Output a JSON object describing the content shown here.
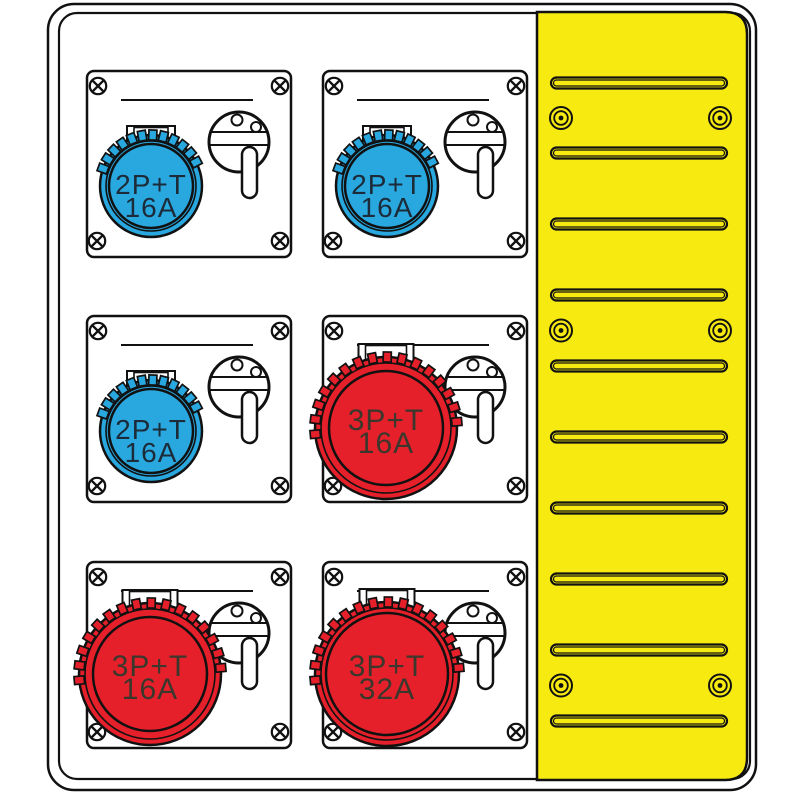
{
  "board": {
    "description": "Industrial power distribution board illustration with six interlocked CEE socket modules and a yellow vented side panel",
    "colors": {
      "line": "#111111",
      "plate": "#ffffff",
      "blue_socket": "#29A8E0",
      "red_socket": "#E6202A",
      "panel_yellow": "#F7EA11",
      "blue_label_text": "#1C2B39",
      "red_label_text": "#3B372D"
    },
    "modules": [
      {
        "position": "top-left",
        "type": "blue",
        "socket_type": "2P+T",
        "rating": "16A",
        "label_line1": "2P+T",
        "label_line2": "16A",
        "color": "#29A8E0",
        "label_color": "#1C2B39"
      },
      {
        "position": "top-right",
        "type": "blue",
        "socket_type": "2P+T",
        "rating": "16A",
        "label_line1": "2P+T",
        "label_line2": "16A",
        "color": "#29A8E0",
        "label_color": "#1C2B39"
      },
      {
        "position": "middle-left",
        "type": "blue",
        "socket_type": "2P+T",
        "rating": "16A",
        "label_line1": "2P+T",
        "label_line2": "16A",
        "color": "#29A8E0",
        "label_color": "#1C2B39"
      },
      {
        "position": "middle-right",
        "type": "red16",
        "socket_type": "3P+T",
        "rating": "16A",
        "label_line1": "3P+T",
        "label_line2": "16A",
        "color": "#E6202A",
        "label_color": "#3B372D"
      },
      {
        "position": "bottom-left",
        "type": "red16",
        "socket_type": "3P+T",
        "rating": "16A",
        "label_line1": "3P+T",
        "label_line2": "16A",
        "color": "#E6202A",
        "label_color": "#3B372D"
      },
      {
        "position": "bottom-right",
        "type": "red32",
        "socket_type": "3P+T",
        "rating": "32A",
        "label_line1": "3P+T",
        "label_line2": "32A",
        "color": "#E6202A",
        "label_color": "#3B372D"
      }
    ],
    "side_panel": {
      "color": "#F7EA11",
      "slot_count": 10,
      "rivet_pair_rows": 3,
      "rivets_per_row": 2
    }
  }
}
